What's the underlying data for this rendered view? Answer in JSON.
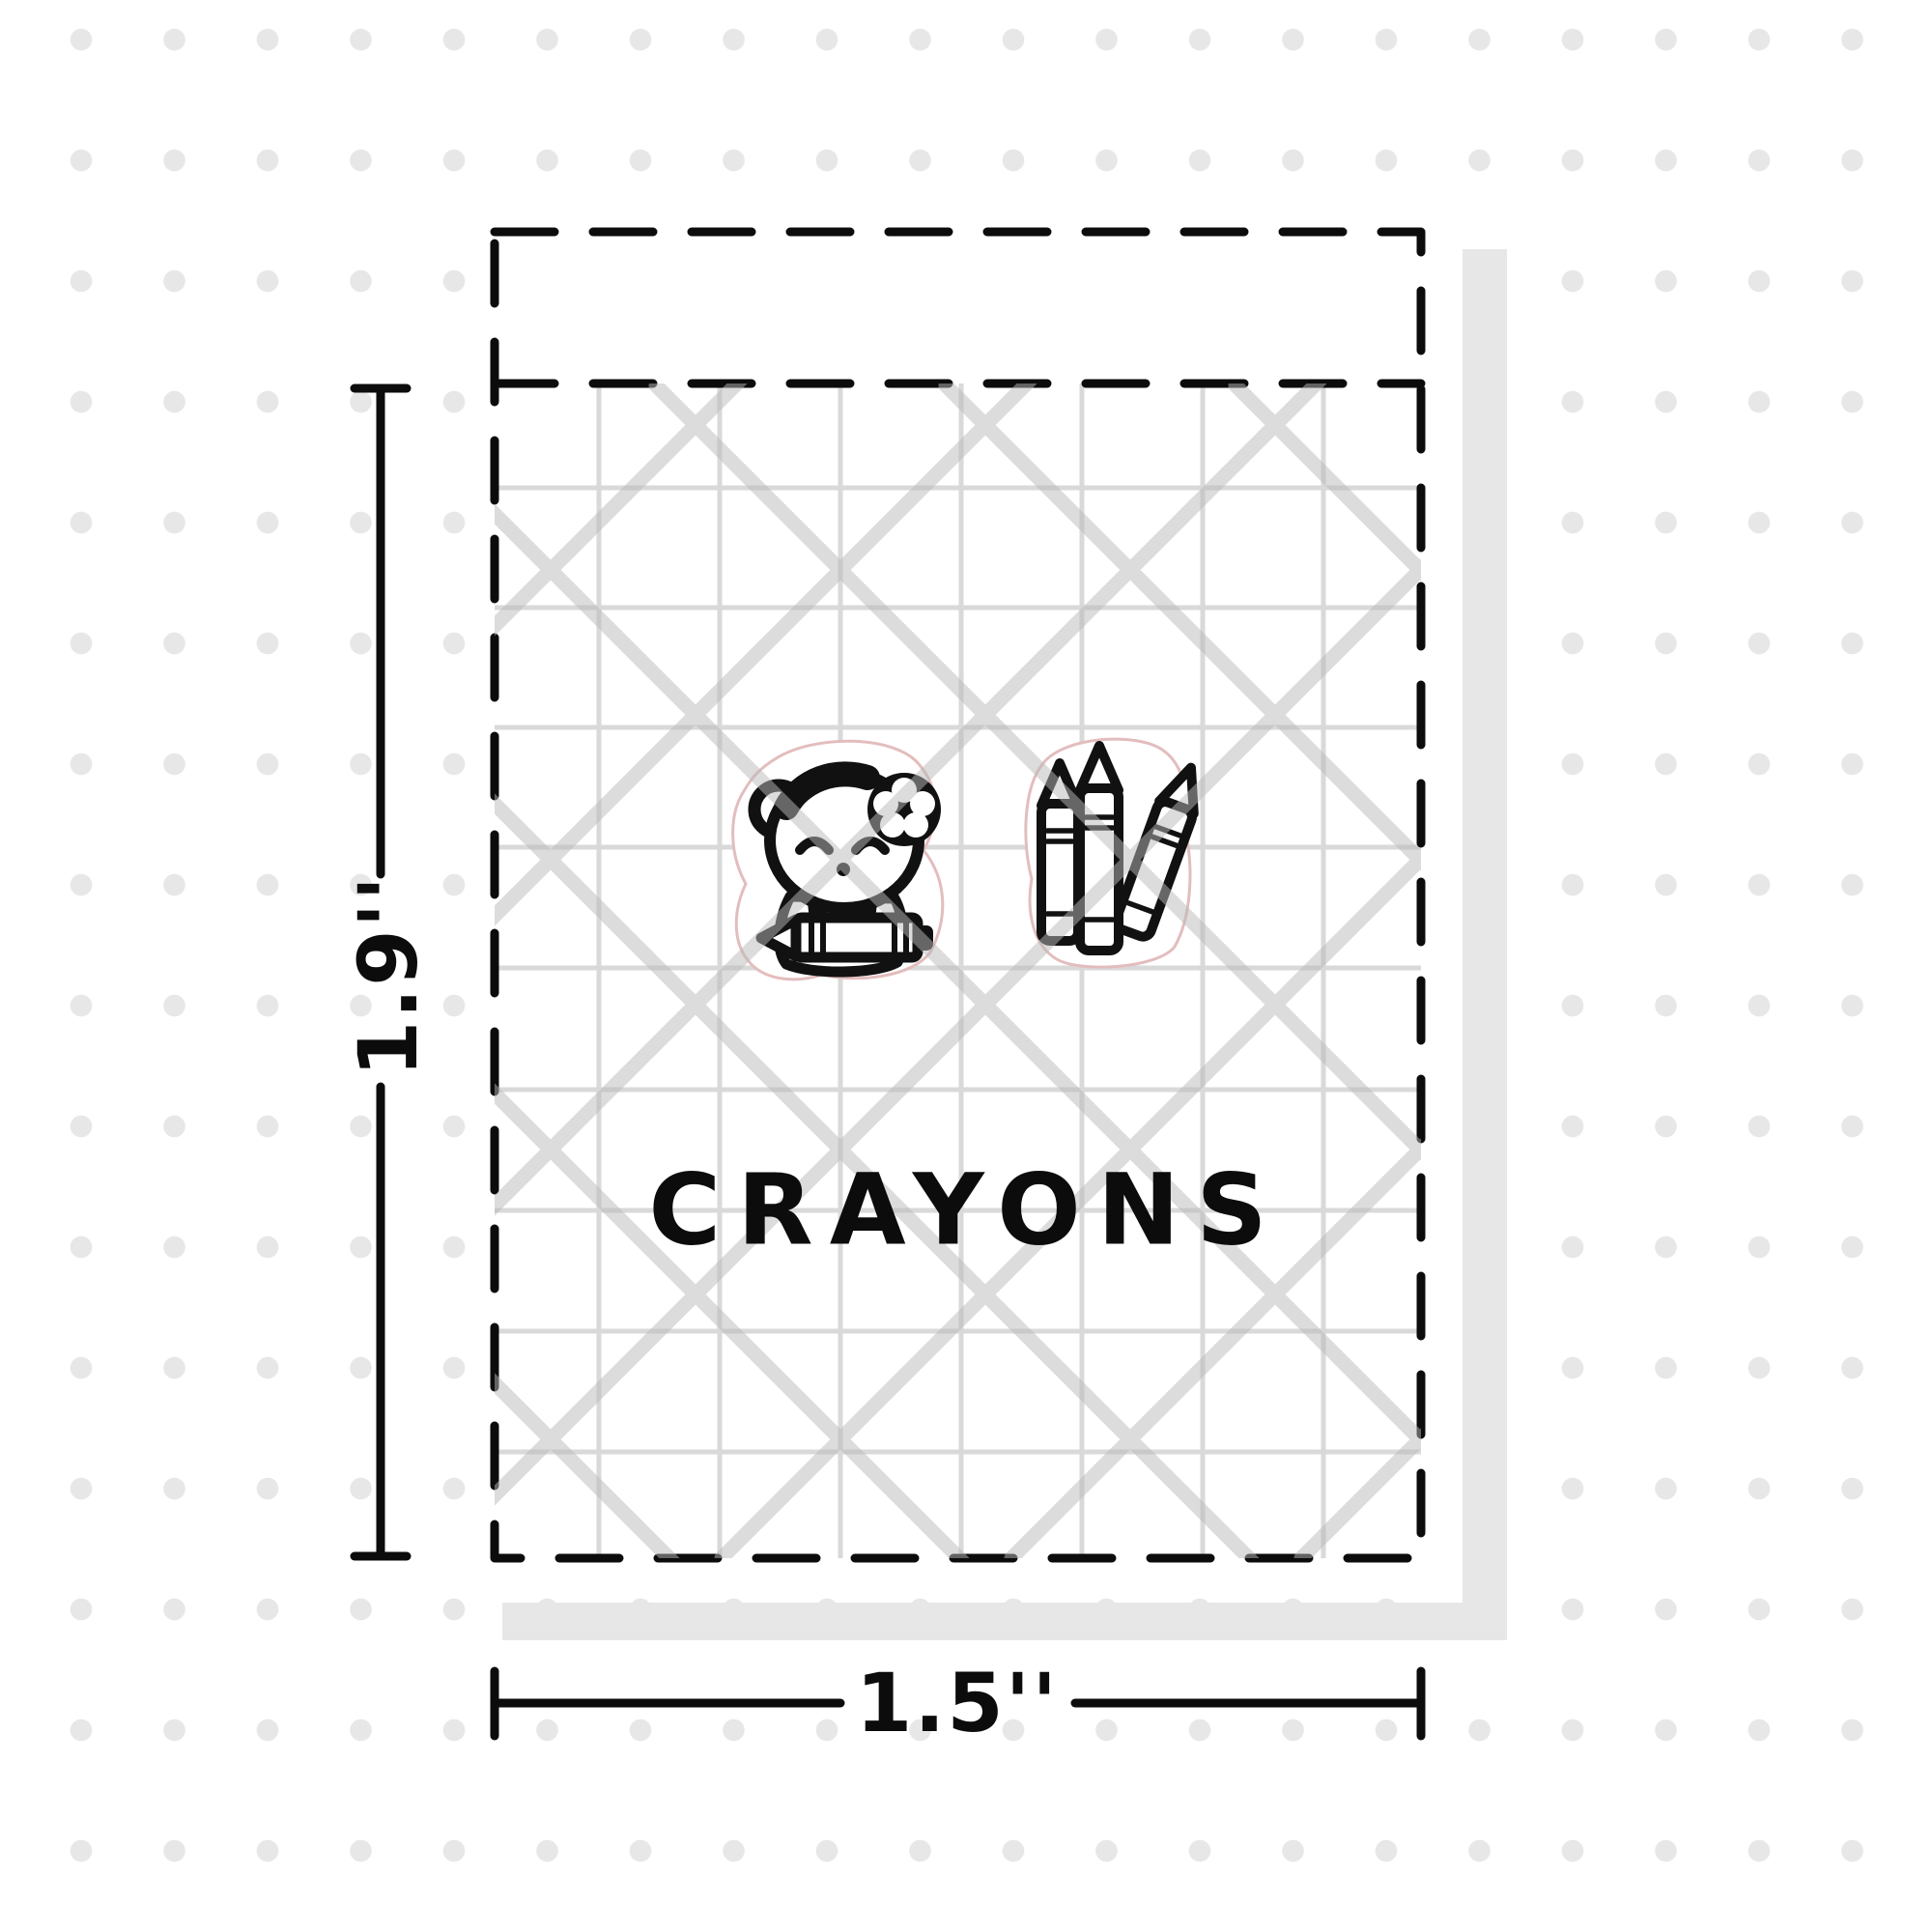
{
  "sheet": {
    "title": "CRAYONS",
    "width_label": "1.5''",
    "height_label": "1.9''"
  },
  "stickers": [
    {
      "name": "bear-with-crayon-sticker"
    },
    {
      "name": "crayon-bundle-sticker"
    }
  ],
  "colors": {
    "ink": "#0c0c0c",
    "grid_line": "#d9d9d9",
    "shadow": "#e7e7e7",
    "background_dot": "#e7e7e7",
    "die_cut_line": "#e3bdbd"
  }
}
